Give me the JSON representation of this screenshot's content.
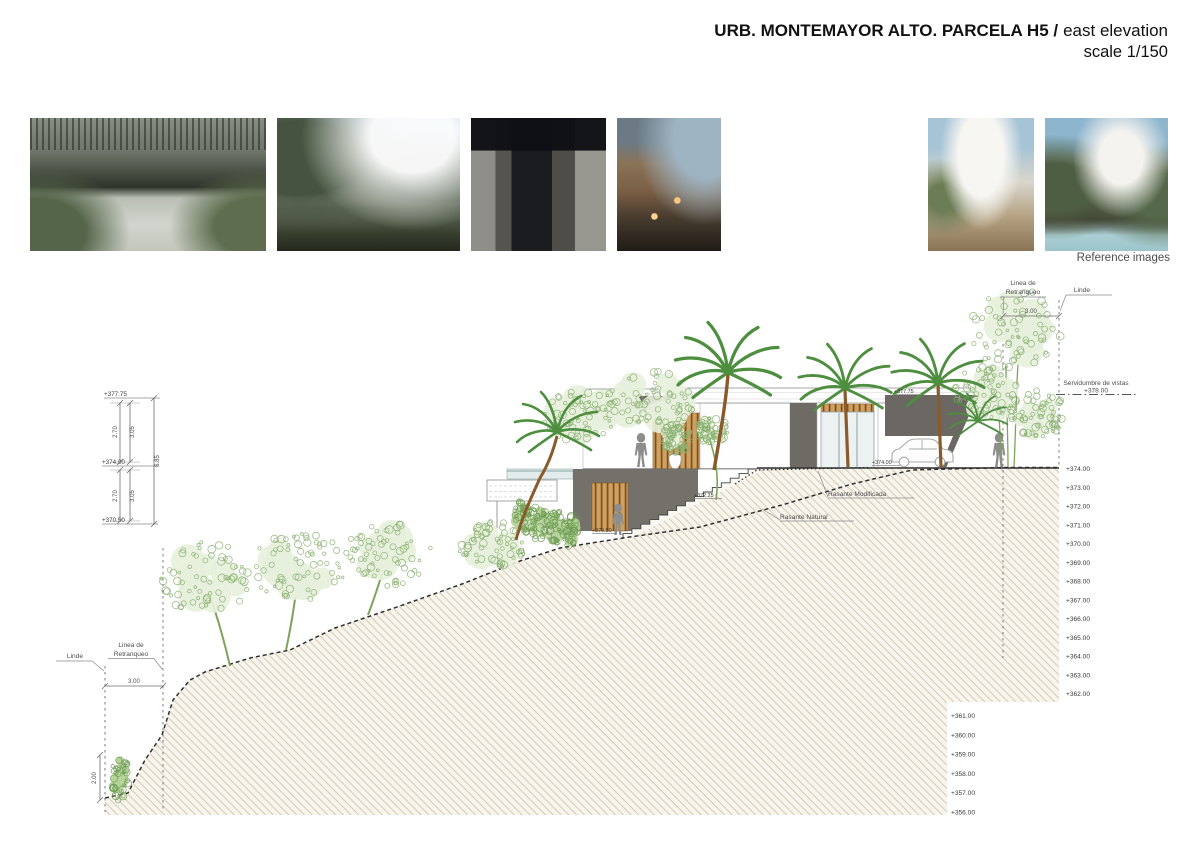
{
  "header": {
    "title_bold": "URB. MONTEMAYOR ALTO. PARCELA H5 /",
    "title_light": "east elevation",
    "scale": "scale 1/150"
  },
  "reference_strip": {
    "caption": "Reference images",
    "images": [
      {
        "desc": "entry courtyard with slatted pergola and stepping stones over dark pool"
      },
      {
        "desc": "white flat-roof villa among palms under blue sky"
      },
      {
        "desc": "dark stone entrance with vertical timber slats"
      },
      {
        "desc": "timber-clad house at dusk with warm lights"
      },
      {
        "desc": "stone courtyard with reflecting pool and white car"
      },
      {
        "desc": "curved white roof house on rocky slope"
      },
      {
        "desc": "sculptural curved roofs over pool terrace"
      }
    ]
  },
  "drawing": {
    "top_right": {
      "setback_l1": "Linea de",
      "setback_l2": "Retranqueo",
      "linde": "Linde",
      "setback_dim": "3.00",
      "servidumbre": "Servidumbre de vistas",
      "servidumbre_level": "+378.00"
    },
    "left_stack": {
      "top": "+377.75",
      "mid": "+374.00",
      "low": "+370.50",
      "d1": "2.70",
      "d2": "3.05",
      "total": "6.85",
      "d3": "2.70",
      "d4": "3.05"
    },
    "building": {
      "roof": "+377.75",
      "entry": "+374.00",
      "landing": "+372.25",
      "lower": "+370.50"
    },
    "grades": {
      "modified": "Rasante Modificada",
      "natural": "Rasante Natural"
    },
    "bottom_left": {
      "linde": "Linde",
      "setback_l1": "Linea de",
      "setback_l2": "Retranqueo",
      "setback_dim": "3.00",
      "tree_height": "2.00"
    },
    "right_ticks": [
      "+374.00",
      "+373.00",
      "+372.00",
      "+371.00",
      "+370.00",
      "+369.00",
      "+368.00",
      "+367.00",
      "+366.00",
      "+365.00",
      "+364.00",
      "+363.00",
      "+362.00"
    ],
    "lower_ticks": [
      "+361.00",
      "+360.00",
      "+359.00",
      "+358.00",
      "+357.00",
      "+356.00"
    ]
  }
}
